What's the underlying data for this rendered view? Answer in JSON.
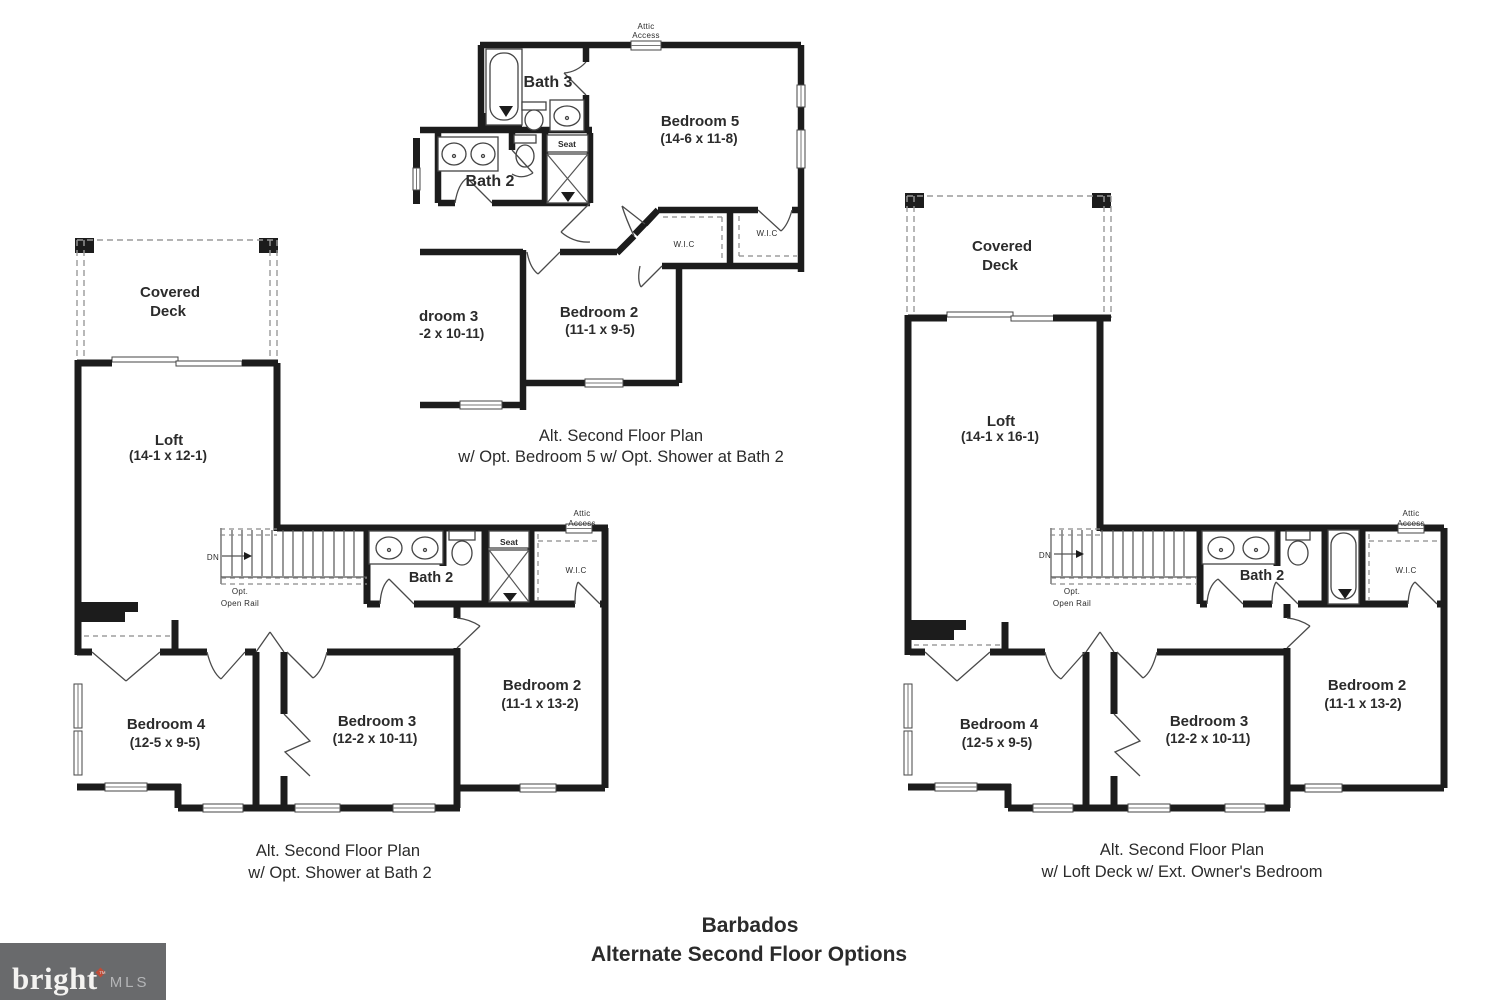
{
  "plans": {
    "a": {
      "attic1": "Attic",
      "attic2": "Access",
      "bath3": "Bath 3",
      "bedroom5": "Bedroom 5",
      "bedroom5_dims": "(14-6 x 11-8)",
      "bath2": "Bath 2",
      "seat": "Seat",
      "wic_left": "W.I.C",
      "wic_right": "W.I.C",
      "bedroom3_cut": "droom 3",
      "bedroom3_cut_dims": "-2 x 10-11)",
      "bedroom2": "Bedroom 2",
      "bedroom2_dims": "(11-1 x 9-5)",
      "caption1": "Alt. Second Floor Plan",
      "caption2": "w/ Opt. Bedroom 5 w/ Opt. Shower at Bath 2"
    },
    "b": {
      "deck1": "Covered",
      "deck2": "Deck",
      "loft": "Loft",
      "loft_dims": "(14-1 x 12-1)",
      "dn": "DN",
      "rail1": "Opt.",
      "rail2": "Open Rail",
      "attic1": "Attic",
      "attic2": "Access",
      "bath2": "Bath 2",
      "seat": "Seat",
      "wic": "W.I.C",
      "bedroom4": "Bedroom 4",
      "bedroom4_dims": "(12-5 x 9-5)",
      "bedroom3": "Bedroom 3",
      "bedroom3_dims": "(12-2 x 10-11)",
      "bedroom2": "Bedroom 2",
      "bedroom2_dims": "(11-1 x 13-2)",
      "caption1": "Alt. Second Floor Plan",
      "caption2": "w/ Opt. Shower at Bath 2"
    },
    "c": {
      "deck1": "Covered",
      "deck2": "Deck",
      "loft": "Loft",
      "loft_dims": "(14-1 x 16-1)",
      "dn": "DN",
      "rail1": "Opt.",
      "rail2": "Open Rail",
      "attic1": "Attic",
      "attic2": "Access",
      "bath2": "Bath 2",
      "wic": "W.I.C",
      "bedroom4": "Bedroom 4",
      "bedroom4_dims": "(12-5 x 9-5)",
      "bedroom3": "Bedroom 3",
      "bedroom3_dims": "(12-2 x 10-11)",
      "bedroom2": "Bedroom 2",
      "bedroom2_dims": "(11-1 x 13-2)",
      "caption1": "Alt. Second Floor Plan",
      "caption2": "w/ Loft Deck w/ Ext. Owner's Bedroom"
    }
  },
  "footer": {
    "title": "Barbados",
    "subtitle": "Alternate Second Floor Options"
  },
  "logo": {
    "brand": "bright",
    "tm": "™",
    "suffix": "MLS"
  },
  "colors": {
    "wall": "#1c1c1c",
    "logo_bg": "#696a6c",
    "logo_diamond": "#bf4b37",
    "logo_brand": "#f4f3f1",
    "logo_suffix": "#b4b5b7"
  }
}
